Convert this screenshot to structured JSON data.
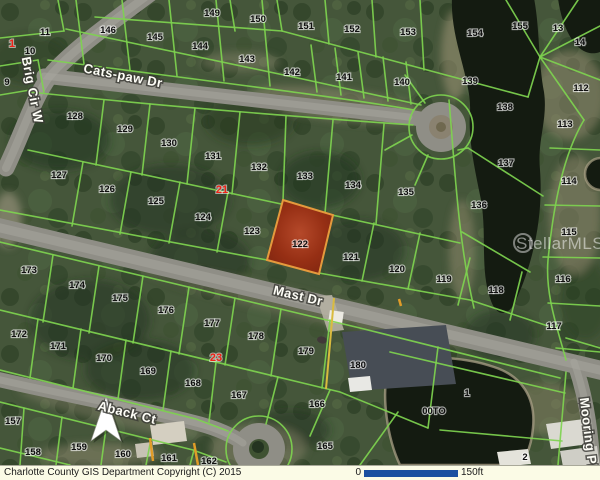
{
  "map": {
    "watermark": "StellarMLS",
    "lake_label": "00TO",
    "streets": {
      "catspaw": "Cats-paw Dr",
      "brig": "Brig Cir W",
      "mast": "Mast Dr",
      "aback": "Aback Ct",
      "mooring": "Mooring Pl"
    },
    "markers": {
      "m1": "1",
      "m21": "21",
      "m23": "23"
    },
    "selected_parcel": "122",
    "lots": {
      "l9": "9",
      "l10": "10",
      "l11": "11",
      "l13": "13",
      "l14": "14",
      "l112": "112",
      "l113": "113",
      "l114": "114",
      "l115": "115",
      "l116": "116",
      "l117": "117",
      "l118": "118",
      "l119": "119",
      "l120": "120",
      "l121": "121",
      "l122": "122",
      "l123": "123",
      "l124": "124",
      "l125": "125",
      "l126": "126",
      "l127": "127",
      "l128": "128",
      "l129": "129",
      "l130": "130",
      "l131": "131",
      "l132": "132",
      "l133": "133",
      "l134": "134",
      "l135": "135",
      "l136": "136",
      "l137": "137",
      "l138": "138",
      "l139": "139",
      "l140": "140",
      "l141": "141",
      "l142": "142",
      "l143": "143",
      "l144": "144",
      "l145": "145",
      "l146": "146",
      "l149": "149",
      "l150": "150",
      "l151": "151",
      "l152": "152",
      "l153": "153",
      "l154": "154",
      "l155": "155",
      "l157": "157",
      "l158": "158",
      "l159": "159",
      "l160": "160",
      "l161": "161",
      "l162": "162",
      "l165": "165",
      "l166": "166",
      "l167": "167",
      "l168": "168",
      "l169": "169",
      "l170": "170",
      "l171": "171",
      "l172": "172",
      "l173": "173",
      "l174": "174",
      "l175": "175",
      "l176": "176",
      "l177": "177",
      "l178": "178",
      "l179": "179",
      "l180": "180",
      "l1": "1",
      "l2": "2"
    }
  },
  "footer": {
    "copyright": "Charlotte County GIS Department Copyright (C) 2015",
    "scale_start": "0",
    "scale_end": "150ft"
  },
  "colors": {
    "parcel_line": "#7ed24f",
    "selected_fill": "#9e3318",
    "selected_stroke": "#e59a3d",
    "marker_red": "#ef2318",
    "scale_bar": "#1b4fa0",
    "road": "#8f8e86",
    "water": "#141b11",
    "footer_bg": "#fbfbe6"
  }
}
